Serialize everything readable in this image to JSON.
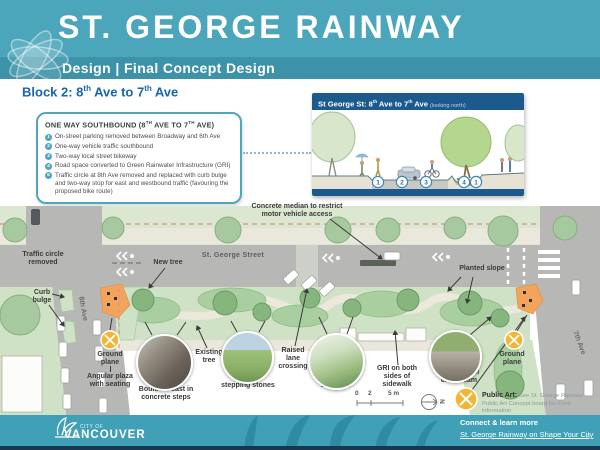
{
  "colors": {
    "header_teal": "#4BA6BC",
    "band_teal": "#3C92A8",
    "footer_teal": "#3FA0B6",
    "navy": "#1C5A8E",
    "block_blue": "#1766AD",
    "accent_teal": "#4FA6BD",
    "street_gray": "#B7B8B5",
    "green_light": "#CFE2C6",
    "orange_plaza": "#F2A45C",
    "icon_yellow": "#F2B632",
    "red_dash": "#DD8E86"
  },
  "header": {
    "title": "ST. GEORGE RAINWAY",
    "subtitle": "Design | Final Concept Design"
  },
  "block_title": {
    "t1": "Block 2: 8",
    "s1": "th",
    "t2": " Ave to 7",
    "s2": "th",
    "t3": " Ave"
  },
  "info_box": {
    "title": {
      "t1": "ONE WAY SOUTHBOUND (8",
      "s1": "TH",
      "t2": " AVE TO 7",
      "s2": "TH",
      "t3": " AVE)"
    },
    "bullets": [
      {
        "num": "1",
        "text": "On-street parking removed between Broadway and 6th Ave"
      },
      {
        "num": "2",
        "text": "One-way vehicle traffic southbound"
      },
      {
        "num": "3",
        "text": "Two-way local street bikeway"
      },
      {
        "num": "4",
        "text": "Road space converted to Green Rainwater Infrastructure (GRI)"
      },
      {
        "num": "5",
        "text": "Traffic circle at 8th Ave removed and replaced with curb bulge and two-way stop for east and westbound traffic (favouring the proposed bike route)"
      }
    ]
  },
  "inset": {
    "title": {
      "t1": "St George St: 8",
      "s1": "th",
      "t2": " Ave to 7",
      "s2": "th",
      "t3": " Ave"
    },
    "subtitle": "(looking north)",
    "numbers": [
      "1",
      "2",
      "3",
      "4",
      "1"
    ]
  },
  "map": {
    "labels": {
      "concrete_median": "Concrete median to restrict\nmotor vehicle access",
      "traffic_circle": "Traffic circle\nremoved",
      "new_tree": "New tree",
      "street_name": "St. George Street",
      "curb_bulge": "Curb\nbulge",
      "planted_slope": "Planted slope",
      "ave8": "8th Ave",
      "ave7": "7th Ave",
      "ground_plane_left": "Ground\nplane",
      "angular_plaza": "Angular plaza\nwith seating",
      "boulders_cast": "Boulders cast in\nconcrete steps",
      "existing_tree": "Existing\ntree",
      "boulder_stepping": "Boulder\nstepping stones",
      "raised_lane": "Raised\nlane\ncrossing",
      "boulders": "Boulders",
      "gri": "GRI on both\nsides of\nsidewalk",
      "corten": "Corten steel\ncheck dam",
      "ground_plane_right": "Ground\nplane"
    },
    "scale": {
      "l0": "0",
      "l1": "2",
      "l2": "5 m"
    },
    "north": "N"
  },
  "public_art": {
    "title": "Public Art:",
    "text": " See St. George Rainway Public Art Concept board for more information"
  },
  "footer": {
    "logo_top": "CITY OF",
    "logo_name": "VANCOUVER",
    "connect": "Connect & learn more",
    "link": "St. George Rainway on Shape Your City",
    "page": "8"
  }
}
